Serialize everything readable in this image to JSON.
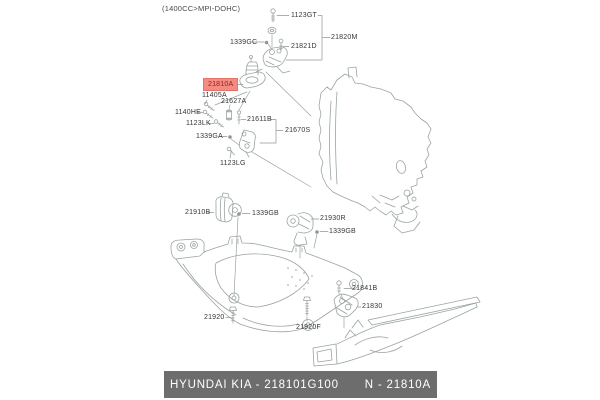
{
  "header": {
    "engine_variant": "(1400CC>MPI-DOHC)"
  },
  "diagram": {
    "highlighted_part": "21810A",
    "labels": [
      {
        "part": "1123GT"
      },
      {
        "part": "21820M"
      },
      {
        "part": "1339GC"
      },
      {
        "part": "21821D"
      },
      {
        "part": "21810A"
      },
      {
        "part": "11405A"
      },
      {
        "part": "21627A"
      },
      {
        "part": "1140HE"
      },
      {
        "part": "1123LK"
      },
      {
        "part": "21611B"
      },
      {
        "part": "1339GA"
      },
      {
        "part": "21670S"
      },
      {
        "part": "1123LG"
      },
      {
        "part": "21910B"
      },
      {
        "part": "1339GB"
      },
      {
        "part": "21930R"
      },
      {
        "part": "1339GB"
      },
      {
        "part": "21920"
      },
      {
        "part": "21920F"
      },
      {
        "part": "21841B"
      },
      {
        "part": "21830"
      }
    ]
  },
  "footer": {
    "left": "HYUNDAI  KIA - 218101G100",
    "right": "N - 21810A",
    "brand": "HYUNDAI KIA",
    "part_number": "218101G100"
  },
  "colors": {
    "highlight_bg": "#f28b82",
    "highlight_text": "#9c1a1a",
    "footer_bg": "#6d6d6d",
    "footer_text": "#ffffff",
    "line_art": "#9aa3a3",
    "label_text": "#363636"
  }
}
